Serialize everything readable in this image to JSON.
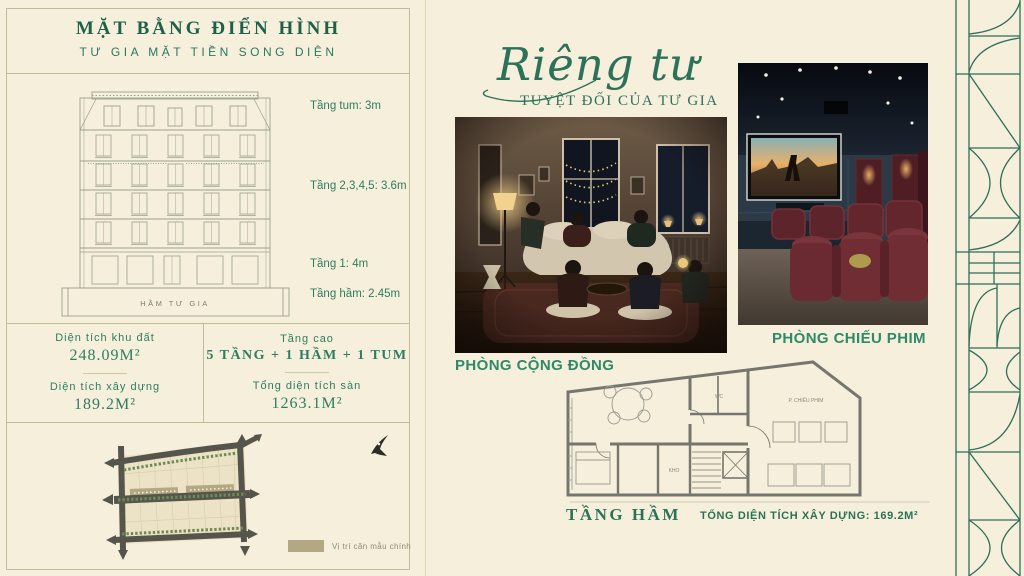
{
  "colors": {
    "background": "#f5efdb",
    "accent_green": "#1e6b50",
    "caption_green": "#2e8a68",
    "line_olive": "#c3ba97",
    "legend_swatch": "#b3a884"
  },
  "left_panel": {
    "title": "MẶT BẰNG ĐIỂN HÌNH",
    "subtitle": "TƯ GIA MẶT TIỀN SONG DIỆN",
    "floor_labels": [
      {
        "label": "Tầng tum: 3m"
      },
      {
        "label": "Tầng 2,3,4,5: 3.6m"
      },
      {
        "label": "Tầng 1: 4m"
      },
      {
        "label": "Tầng hầm: 2.45m"
      }
    ],
    "basement_label": "HẦM TƯ GIA",
    "stats": {
      "left": [
        {
          "label": "Diện tích khu đất",
          "value": "248.09M²"
        },
        {
          "label": "Diện tích xây dựng",
          "value": "189.2M²"
        }
      ],
      "right": [
        {
          "label": "Tầng cao",
          "value": "5 TẦNG + 1 HẦM + 1 TUM"
        },
        {
          "label": "Tổng diện tích sàn",
          "value": "1263.1M²"
        }
      ]
    },
    "legend": {
      "label": "Vị trí căn mẫu chính"
    }
  },
  "right_section": {
    "headline": {
      "script": "Riêng tư",
      "sub": "TUYỆT ĐỐI CỦA TƯ GIA"
    },
    "captions": {
      "community": "PHÒNG CỘNG ĐỒNG",
      "cinema": "PHÒNG CHIẾU PHIM"
    },
    "plan": {
      "caption": "TẦNG HẦM",
      "total": "TỔNG DIỆN TÍCH XÂY DỰNG: 169.2M²",
      "rooms": {
        "wc": "WC",
        "cinema": "P. CHIẾU PHIM",
        "storage": "KHO"
      }
    }
  }
}
